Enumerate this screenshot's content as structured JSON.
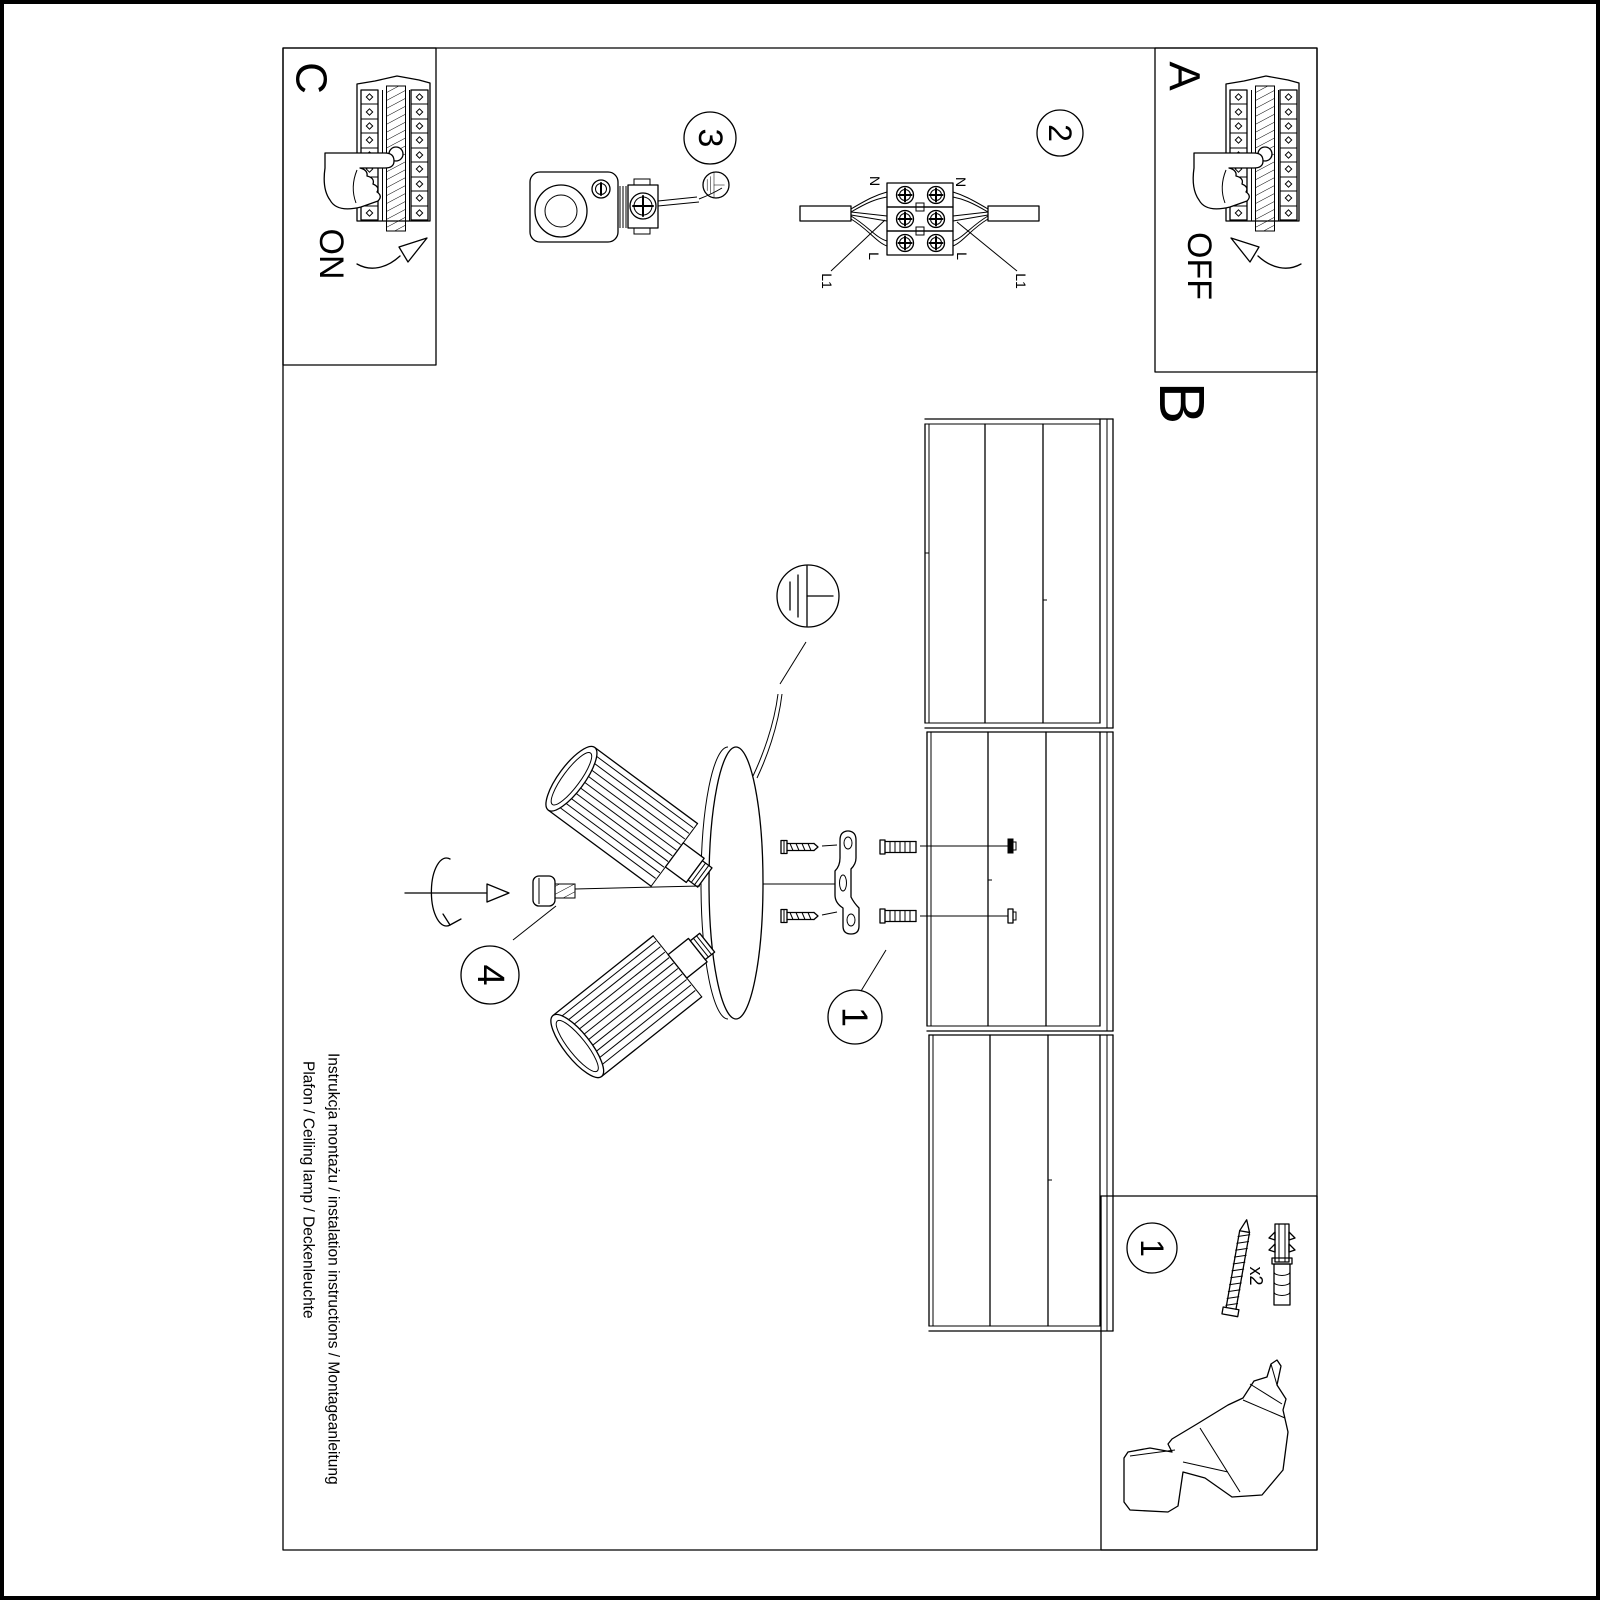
{
  "sheet": {
    "colors": {
      "ink": "#000000",
      "paper": "#ffffff"
    },
    "panels": {
      "a": "A",
      "b": "B",
      "c": "C"
    },
    "switch": {
      "on": "ON",
      "off": "OFF"
    },
    "steps": {
      "s1": "1",
      "s1_box": "1",
      "s2": "2",
      "s3": "3",
      "s4": "4"
    },
    "wiring": {
      "n_left": "N",
      "n_right": "N",
      "l_left": "L",
      "l_right": "L",
      "l1_left": "L1",
      "l1_right": "L1"
    },
    "accessories": {
      "qty": "x2"
    },
    "footer": {
      "line1": "Instrukcja montażu / instalation instructions / Montageanleitung",
      "line2": "Plafon / Ceiling lamp / Deckenleuchte"
    }
  }
}
